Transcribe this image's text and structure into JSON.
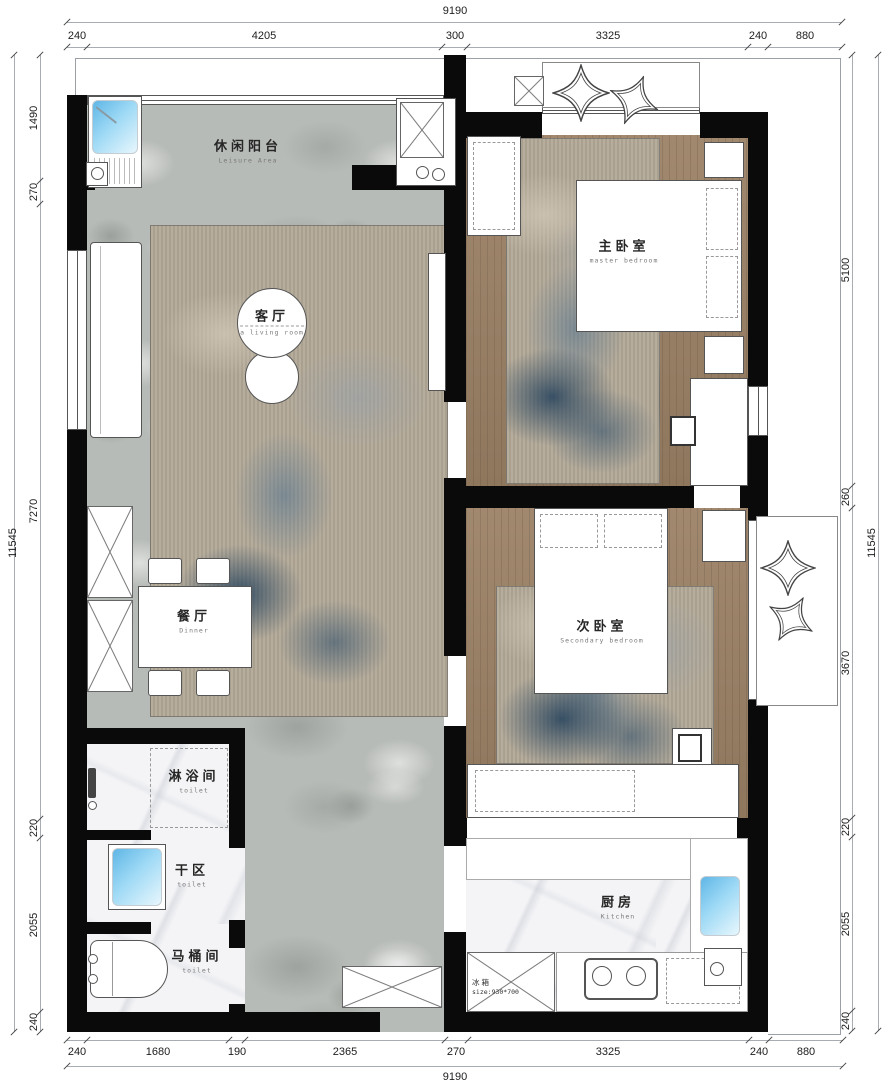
{
  "drawing": {
    "rooms": {
      "leisure_balcony": {
        "zh": "休闲阳台",
        "en": "Leisure Area"
      },
      "living_room": {
        "zh": "客厅",
        "en": "a living room"
      },
      "master_bedroom": {
        "zh": "主卧室",
        "en": "master bedroom"
      },
      "secondary_bedroom": {
        "zh": "次卧室",
        "en": "Secondary bedroom"
      },
      "dining_room": {
        "zh": "餐厅",
        "en": "Dinner"
      },
      "shower_room": {
        "zh": "淋浴间",
        "en": "toilet"
      },
      "dry_area": {
        "zh": "干区",
        "en": "toilet"
      },
      "toilet_room": {
        "zh": "马桶间",
        "en": "toilet"
      },
      "kitchen": {
        "zh": "厨房",
        "en": "Kitchen"
      }
    },
    "annotations": {
      "fridge_label": "冰箱",
      "fridge_size": "size:930*700"
    },
    "dimensions": {
      "top": {
        "total": "9190",
        "segments": [
          "240",
          "4205",
          "300",
          "3325",
          "240",
          "880"
        ]
      },
      "bottom": {
        "total": "9190",
        "segments": [
          "240",
          "1680",
          "190",
          "2365",
          "270",
          "3325",
          "240",
          "880"
        ]
      },
      "left": {
        "total": "11545",
        "segments": [
          "1490",
          "270",
          "7270",
          "220",
          "2055",
          "240"
        ]
      },
      "right": {
        "total": "11545",
        "segments": [
          "5100",
          "260",
          "3670",
          "220",
          "2055",
          "240"
        ]
      }
    },
    "colors": {
      "wall": "#0a0a0a",
      "stone_floor": "#b7bbb7",
      "wood_floor": "#9b8166",
      "marble_floor": "#f4f4f6",
      "rug_blue": "#40607c",
      "sink_blue": "#7cc5ec"
    }
  }
}
